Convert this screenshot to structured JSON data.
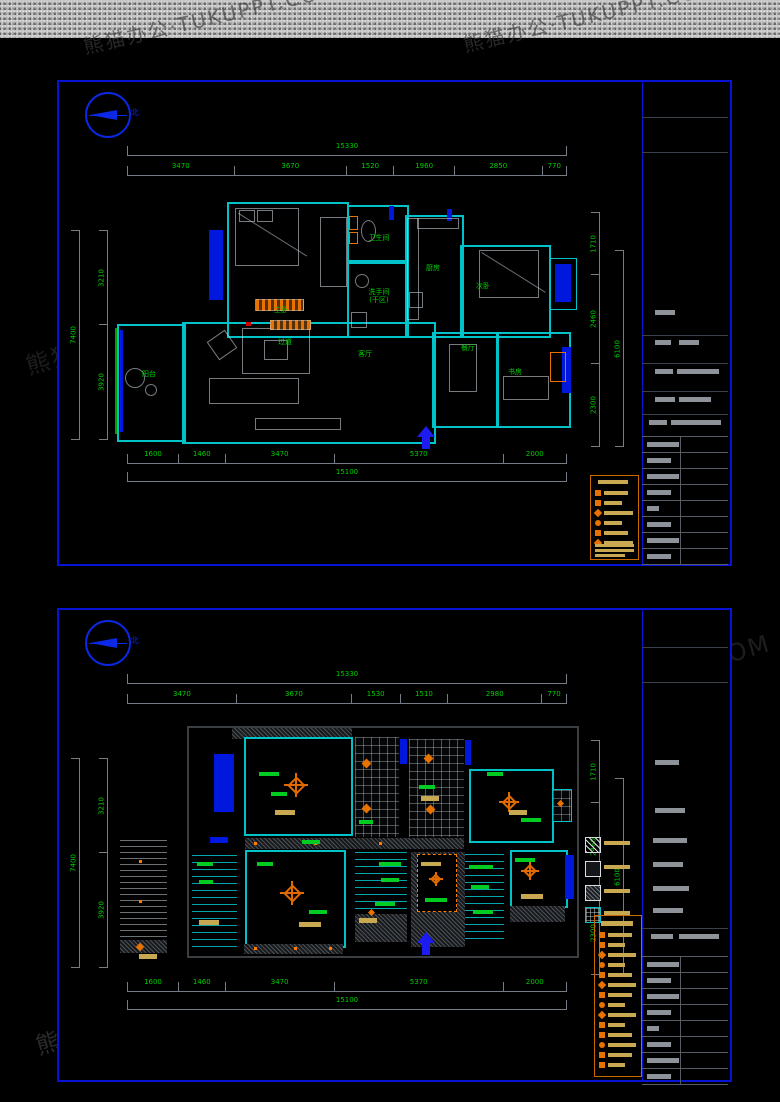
{
  "watermark": {
    "text": "熊猫办公·TUKUPPT.COM"
  },
  "compass_label": "北",
  "plan1": {
    "rooms": {
      "master": "主卧",
      "bath": "卫生间",
      "dry": "洗手间\n(干区)",
      "kitchen": "厨房",
      "bedroom2": "次卧",
      "balcony": "阳台",
      "living": "客厅",
      "hall": "过道",
      "dining": "餐厅",
      "study": "书房"
    },
    "dims": {
      "top": {
        "total": "15330",
        "segs": [
          "3470",
          "3670",
          "1520",
          "1960",
          "2850",
          "770"
        ]
      },
      "bottom": {
        "total": "15100",
        "segs": [
          "1600",
          "1460",
          "3470",
          "5370",
          "2000"
        ]
      },
      "left": {
        "overall": "7400",
        "segs": [
          "3210",
          "3920"
        ]
      },
      "right": {
        "overall": "6100",
        "segs": [
          "1710",
          "2460",
          "2300"
        ]
      }
    }
  },
  "plan2": {
    "dims": {
      "top": {
        "total": "15330",
        "segs": [
          "3470",
          "3670",
          "1530",
          "1510",
          "2980",
          "770"
        ]
      },
      "bottom": {
        "total": "15100",
        "segs": [
          "1600",
          "1460",
          "3470",
          "5370",
          "2000"
        ]
      },
      "left": {
        "overall": "7400",
        "segs": [
          "3210",
          "3920"
        ]
      },
      "right": {
        "overall": "6100",
        "segs": [
          "1710",
          "2460",
          "2300"
        ]
      }
    }
  }
}
